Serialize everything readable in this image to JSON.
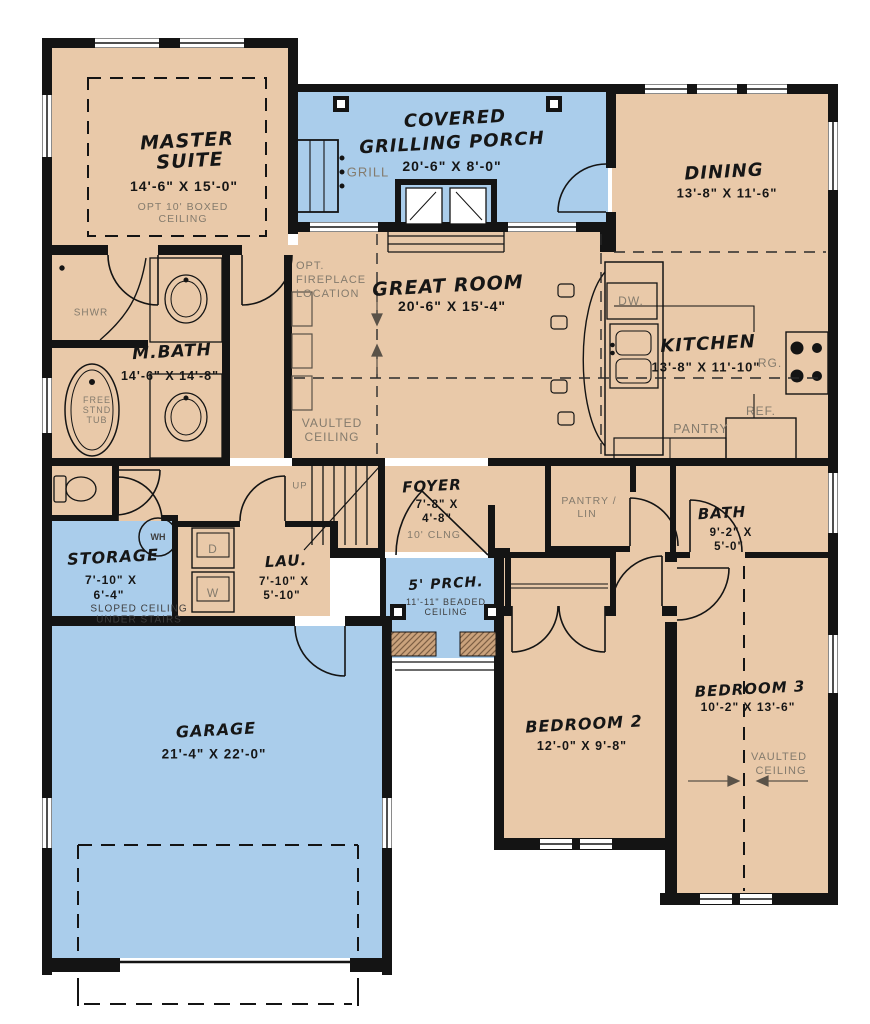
{
  "palette": {
    "floor_tan": "#e9c9a9",
    "porch_blue": "#aacdeb",
    "wall_black": "#141414",
    "note_gray": "#847b6d"
  },
  "rooms": {
    "master": {
      "name_line1": "MASTER",
      "name_line2": "SUITE",
      "dims": "14'-6\" X 15'-0\"",
      "note_line1": "OPT 10' BOXED",
      "note_line2": "CEILING"
    },
    "grilling_porch": {
      "name_line1": "COVERED",
      "name_line2": "GRILLING PORCH",
      "dims": "20'-6\" X 8'-0\"",
      "grill": "GRILL"
    },
    "dining": {
      "name": "DINING",
      "dims": "13'-8\" X 11'-6\""
    },
    "great_room": {
      "name": "GREAT ROOM",
      "dims": "20'-6\" X 15'-4\"",
      "fireplace_note_line1": "OPT.",
      "fireplace_note_line2": "FIREPLACE",
      "fireplace_note_line3": "LOCATION",
      "ceiling_note_line1": "VAULTED",
      "ceiling_note_line2": "CEILING"
    },
    "kitchen": {
      "name": "KITCHEN",
      "dims": "13'-8\" X 11'-10\"",
      "dishwasher": "DW.",
      "range": "RG.",
      "refrigerator": "REF.",
      "pantry": "PANTRY"
    },
    "master_bath": {
      "name": "M.BATH",
      "dims": "14'-6\" X 14'-8\"",
      "shower": "SHWR",
      "tub_line1": "FREE",
      "tub_line2": "STND",
      "tub_line3": "TUB"
    },
    "storage": {
      "name": "STORAGE",
      "dims_line1": "7'-10\" X",
      "dims_line2": "6'-4\"",
      "note_line1": "SLOPED CEILING",
      "note_line2": "UNDER STAIRS",
      "water_heater": "WH"
    },
    "laundry": {
      "name": "LAU.",
      "dims_line1": "7'-10\" X",
      "dims_line2": "5'-10\"",
      "dryer": "D",
      "washer": "W"
    },
    "stairs": {
      "up": "UP"
    },
    "foyer": {
      "name": "FOYER",
      "dims_line1": "7'-8\" X",
      "dims_line2": "4'-8\"",
      "note": "10' CLNG"
    },
    "pantry_linen": {
      "line1": "PANTRY /",
      "line2": "LIN"
    },
    "bath": {
      "name": "BATH",
      "dims_line1": "9'-2\" X",
      "dims_line2": "5'-0\""
    },
    "front_porch": {
      "name": "5' PRCH.",
      "note_line1": "11'-11\" BEADED",
      "note_line2": "CEILING"
    },
    "bedroom2": {
      "name": "BEDROOM 2",
      "dims": "12'-0\" X 9'-8\""
    },
    "bedroom3": {
      "name": "BEDROOM 3",
      "dims": "10'-2\" X 13'-6\"",
      "ceiling_note_line1": "VAULTED",
      "ceiling_note_line2": "CEILING"
    },
    "garage": {
      "name": "GARAGE",
      "dims": "21'-4\" X 22'-0\""
    }
  }
}
